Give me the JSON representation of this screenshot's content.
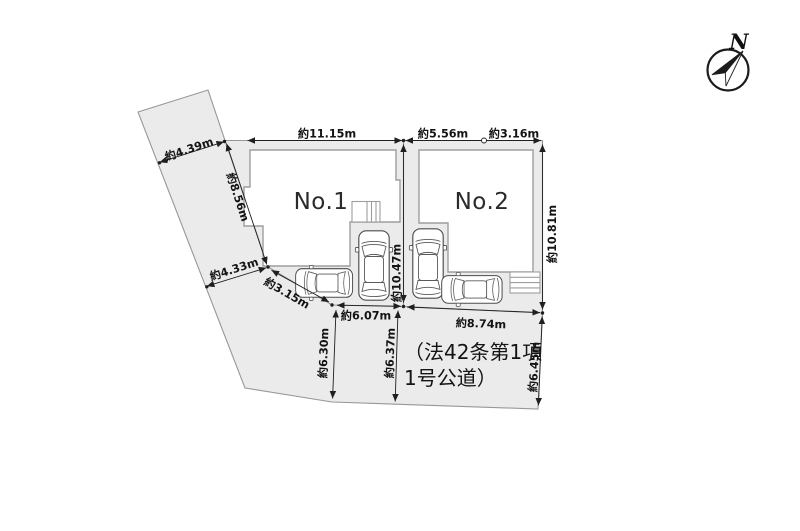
{
  "lots": {
    "lot1_label": "No.1",
    "lot2_label": "No.2"
  },
  "road": {
    "line1": "（法42条第1項",
    "line2": "1号公道）"
  },
  "compass": {
    "north": "N"
  },
  "dimensions": {
    "lot1_top": "約11.15m",
    "lot2_top_left": "約5.56m",
    "lot2_top_right": "約3.16m",
    "west_parcel_top_width": "約4.39m",
    "west_parcel_east_edge": "約8.56m",
    "west_parcel_bottom_width": "約4.33m",
    "southwest_diagonal": "約3.15m",
    "lot1_frontage": "約6.07m",
    "lot2_frontage": "約8.74m",
    "road_width_west": "約6.30m",
    "road_width_center": "約6.37m",
    "road_width_east": "約6.45m",
    "lot_divider": "約10.47m",
    "lot2_east_edge": "約10.81m"
  },
  "colors": {
    "parcel-fill": "#ebebeb",
    "boundary-line": "#979797",
    "dim-line": "#1f1f1f",
    "house-stroke": "#9e9e9e",
    "car-stroke": "#4d4d4d",
    "text-color": "#141414"
  }
}
